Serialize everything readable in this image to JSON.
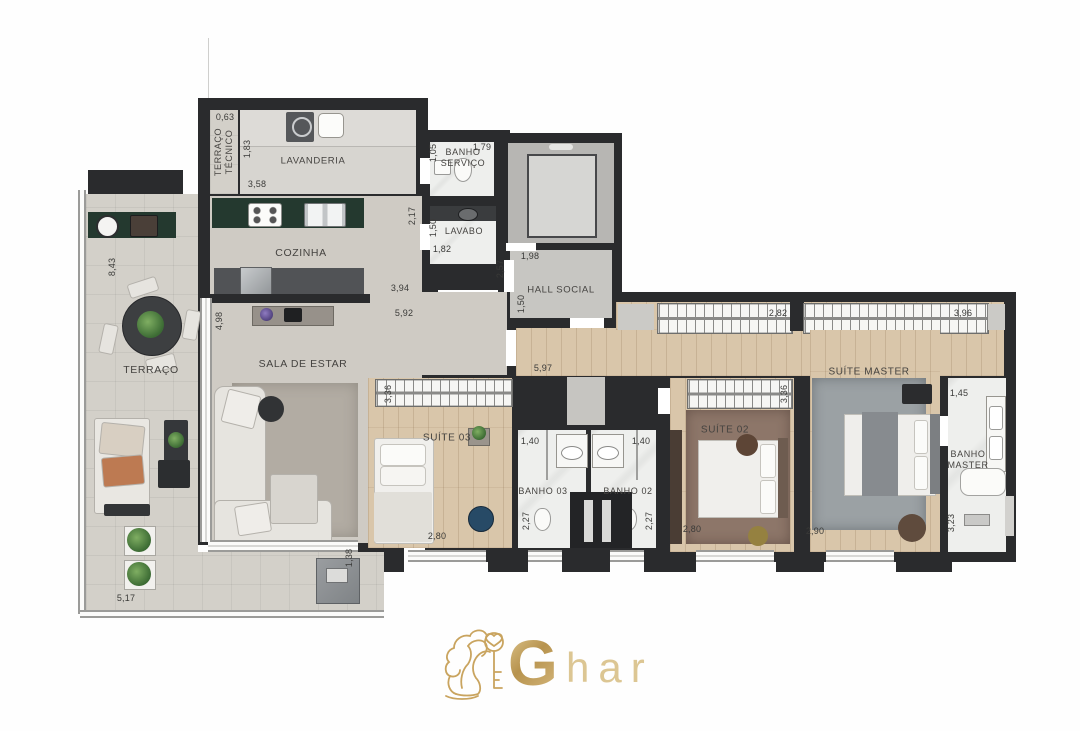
{
  "plan": {
    "type": "apartment-floor-plan",
    "brand": "Ghar"
  },
  "rooms": {
    "terraco_tecnico": "TERRAÇO TÉCNICO",
    "lavanderia": "LAVANDERIA",
    "banho_servico": "BANHO SERVIÇO",
    "lavabo": "LAVABO",
    "hall_social": "HALL SOCIAL",
    "cozinha": "COZINHA",
    "terraco": "TERRAÇO",
    "sala": "SALA DE ESTAR",
    "suite03": "SUÍTE 03",
    "banho03": "BANHO 03",
    "banho02": "BANHO 02",
    "suite02": "SUÍTE 02",
    "suite_master": "SUÍTE MASTER",
    "banho_master": "BANHO MASTER"
  },
  "dims": {
    "tecnico_w": "0,63",
    "tecnico_d": "1,83",
    "lavanderia_w": "3,58",
    "servico_d": "1,05",
    "servico_w": "1,79",
    "cozinha_d": "2,17",
    "lavabo_d": "1,50",
    "lavabo_w": "1,82",
    "hall_w": "1,98",
    "hall_d": "2,57",
    "hall_d2": "1,50",
    "cozinha_w": "3,94",
    "cozinha_w2": "5,92",
    "terraco_d": "8,43",
    "sala_d": "4,98",
    "corredor_w": "5,97",
    "closet1_w": "2,82",
    "closet2_w": "3,96",
    "suite03_ward": "3,36",
    "suite02_ward": "3,36",
    "banho03_w": "1,40",
    "banho02_w": "1,40",
    "banho03_d": "2,27",
    "banho02_d": "2,27",
    "suite03_w": "2,80",
    "suite02_w": "2,80",
    "master_w": "2,90",
    "banho_master_w": "1,45",
    "banho_master_d": "3,23",
    "terraco_w": "5,17",
    "desk_d": "1,38"
  },
  "logo": {
    "g": "G",
    "suffix": "har"
  },
  "colors": {
    "wall": "#2a2b2d",
    "wood": "#d9c6aa",
    "granite": "#24392f",
    "gold": "#c9a45f"
  }
}
